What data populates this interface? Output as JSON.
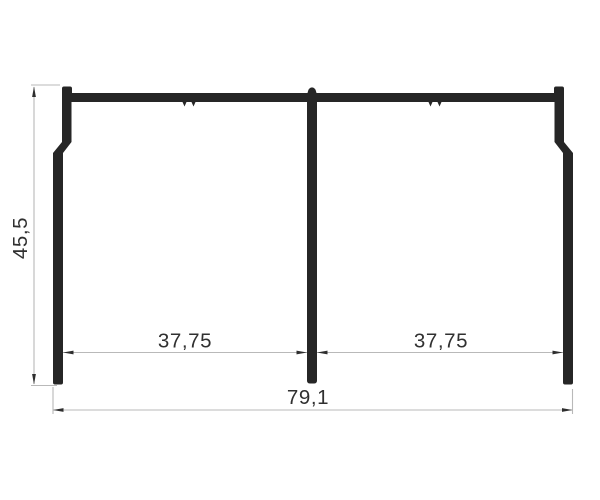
{
  "drawing": {
    "kind": "profile-cross-section-dimension-drawing",
    "dimensions": {
      "height": "45,5",
      "span_left": "37,75",
      "span_right": "37,75",
      "total_width": "79,1"
    },
    "colors": {
      "background": "#ffffff",
      "profile": "#262626",
      "dimension_line": "#b9b9b9",
      "arrow": "#2e2e2e",
      "text": "#303030"
    }
  }
}
